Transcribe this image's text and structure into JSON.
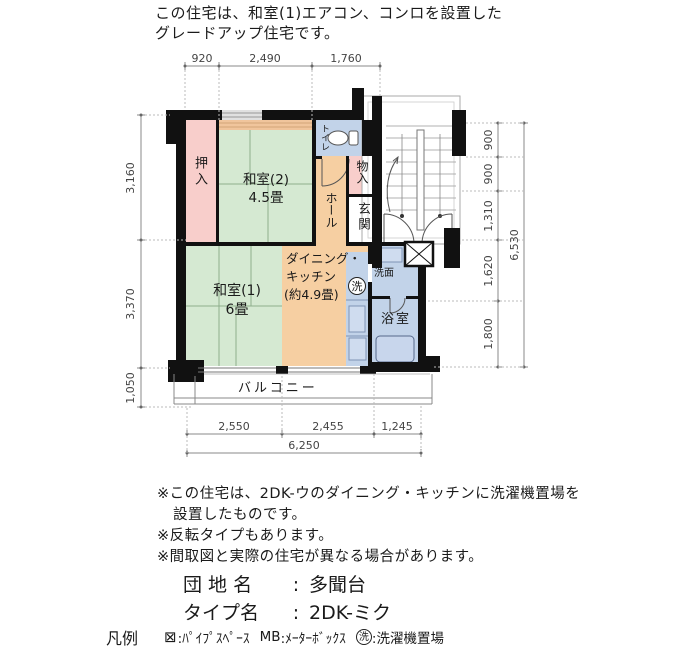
{
  "header": {
    "line1": "この住宅は、和室(1)エアコン、コンロを設置した",
    "line2": "グレードアップ住宅です。"
  },
  "plan": {
    "colors": {
      "tatami": "#d5e9d2",
      "pink": "#f8cecb",
      "orange": "#f6cfa2",
      "blue": "#c2d3e9",
      "strip": "#f0c59c",
      "wall": "#111111",
      "white": "#ffffff"
    },
    "rooms": {
      "oshiire": {
        "label": "押入"
      },
      "washitsu2": {
        "name": "和室(2)",
        "size": "4.5畳"
      },
      "toilet": {
        "label": "トイレ"
      },
      "mono_ire": {
        "label": "物入"
      },
      "hall": {
        "label": "ホール"
      },
      "genkan": {
        "label": "玄関"
      },
      "washitsu1": {
        "name": "和室(1)",
        "size": "6畳"
      },
      "dk": {
        "line1": "ダイニング・",
        "line2": "キッチン",
        "line3": "(約4.9畳)"
      },
      "senmen": {
        "label": "洗面"
      },
      "bath": {
        "label": "浴室"
      },
      "balcony": {
        "label": "バルコニー"
      },
      "washer_symbol": "洗"
    },
    "dimensions": {
      "top": [
        "920",
        "2,490",
        "1,760"
      ],
      "left": [
        "3,160",
        "3,370",
        "1,050"
      ],
      "right": [
        "900",
        "900",
        "1,310",
        "1,620",
        "1,800"
      ],
      "right_total": "6,530",
      "bottom": [
        "2,550",
        "2,455",
        "1,245"
      ],
      "bottom_total": "6,250"
    }
  },
  "notes": {
    "line1": "※この住宅は、2DK-ウのダイニング・キッチンに洗濯機置場を",
    "line2": "設置したものです。",
    "line3": "※反転タイプもあります。",
    "line4": "※間取図と実際の住宅が異なる場合があります。"
  },
  "info": {
    "estate_label": "団 地 名",
    "estate_sep": ":",
    "estate_value": "多聞台",
    "type_label": "タイプ名",
    "type_sep": ":",
    "type_value": "2DK-ミク"
  },
  "legend": {
    "title": "凡例",
    "pipe_symbol": "⊠",
    "pipe_label": ":ﾊﾟｲﾌﾟｽﾍﾟｰｽ",
    "mb_key": "MB",
    "mb_label": ":ﾒｰﾀｰﾎﾞｯｸｽ",
    "washer_symbol": "洗",
    "washer_label": ":洗濯機置場"
  }
}
